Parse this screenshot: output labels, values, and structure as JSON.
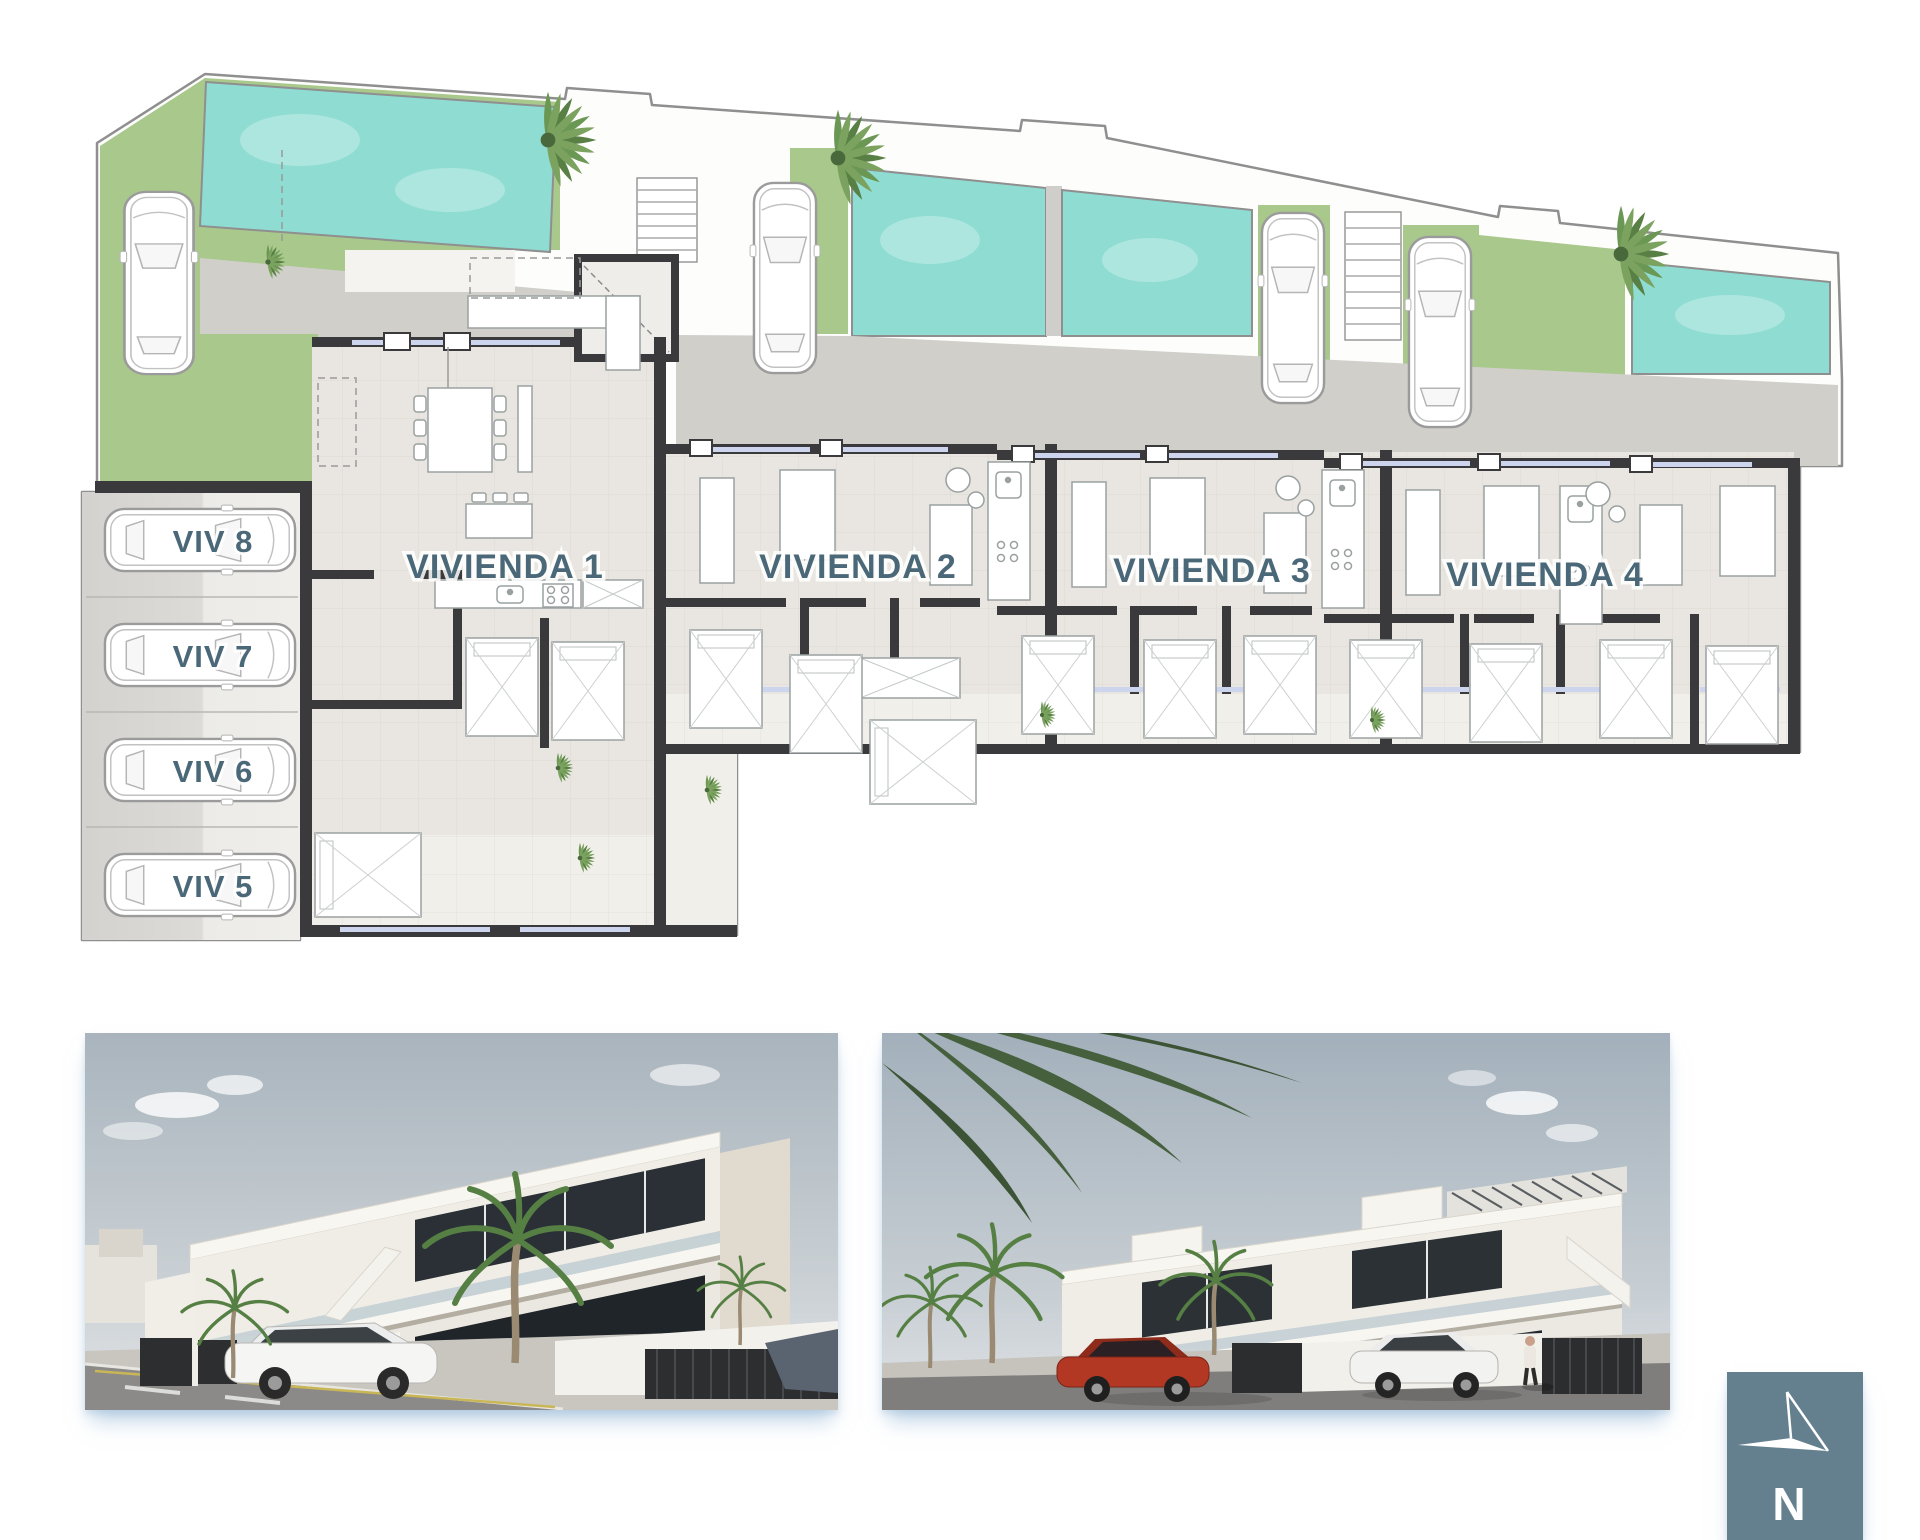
{
  "plan": {
    "units": [
      {
        "label": "VIVIENDA 1"
      },
      {
        "label": "VIVIENDA 2"
      },
      {
        "label": "VIVIENDA 3"
      },
      {
        "label": "VIVIENDA 4"
      }
    ],
    "parking": [
      {
        "label": "VIV 8"
      },
      {
        "label": "VIV 7"
      },
      {
        "label": "VIV 6"
      },
      {
        "label": "VIV 5"
      }
    ],
    "colors": {
      "pool": "#8fdcd3",
      "pool_light": "#c6efe9",
      "grass": "#a9c88c",
      "wall": "#3a3a3c",
      "floor": "#e9e6e1",
      "terrace": "#f1efea",
      "driveway": "#d0cfca",
      "window": "#ccd4ee",
      "label": "#4b6879",
      "furniture_line": "#9aa0a0"
    }
  },
  "renderings": [
    {
      "name": "street-view-corner"
    },
    {
      "name": "street-view-front"
    }
  ],
  "compass": {
    "letter": "N",
    "background": "#64808f",
    "icon": "north-arrow-icon"
  }
}
